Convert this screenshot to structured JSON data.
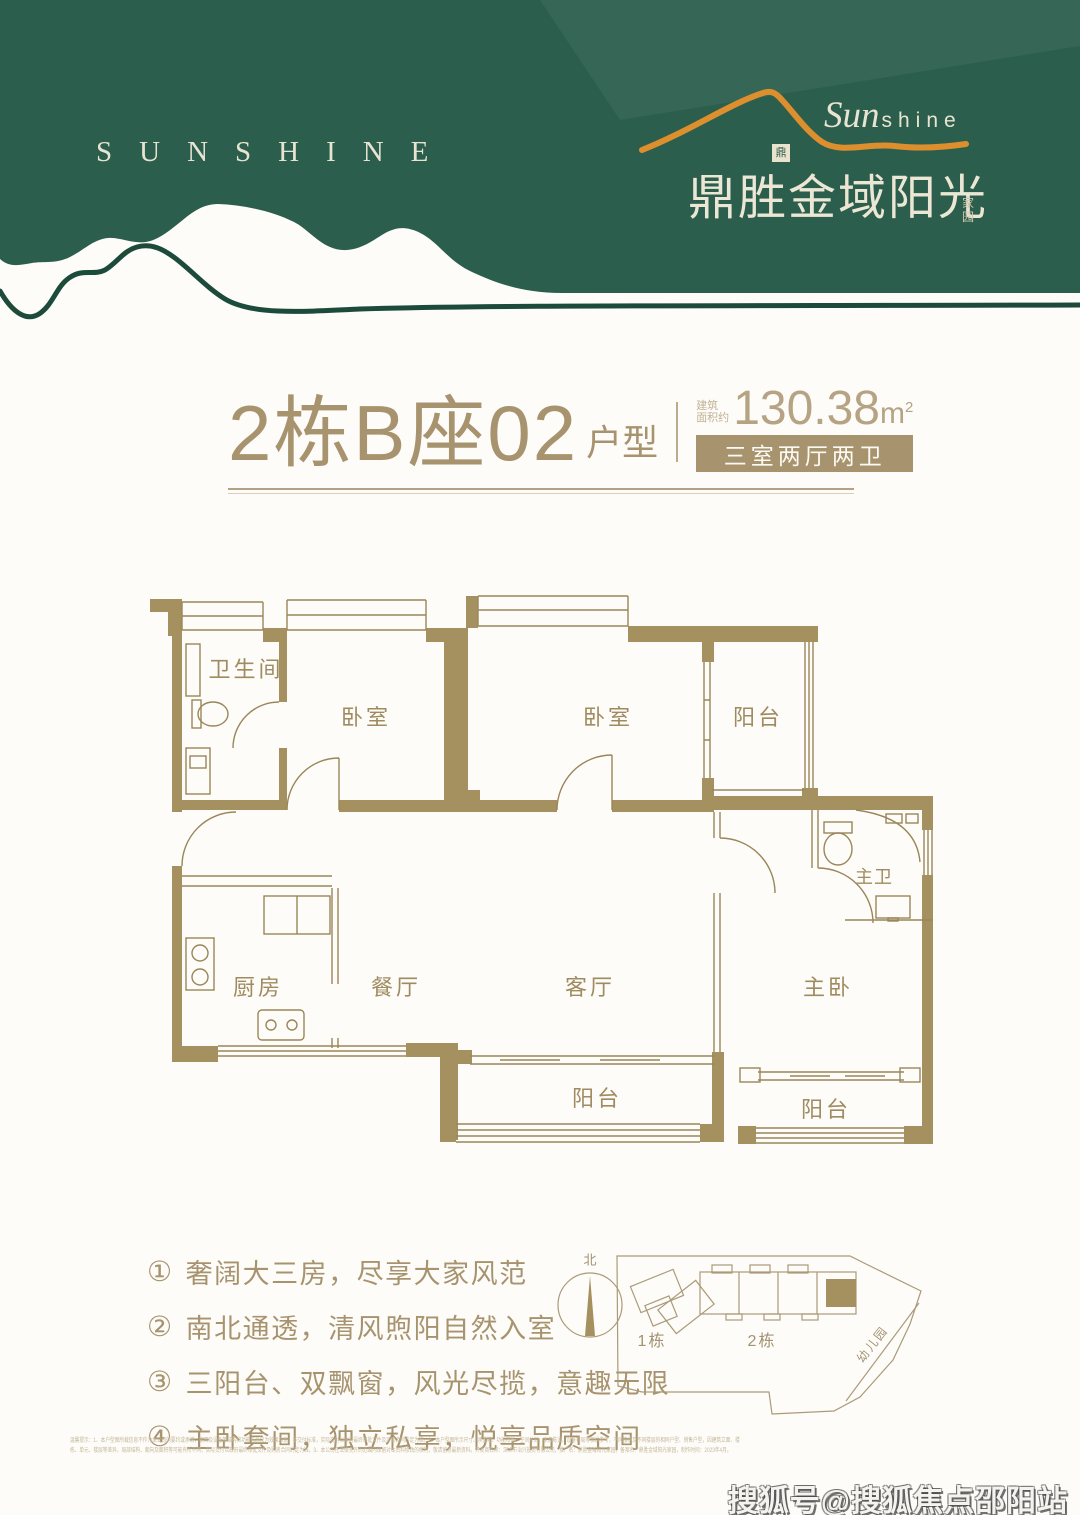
{
  "header": {
    "brand_wordmark": "SUNSHINE",
    "logo_script_primary": "Sun",
    "logo_script_secondary": "shine",
    "logo_cn": "鼎胜金域阳光",
    "logo_cn_suffix": "家园",
    "seal_glyph": "鼎"
  },
  "title": {
    "unit_name": "2栋B座02",
    "unit_suffix": "户型",
    "area_prefix_line1": "建筑",
    "area_prefix_line2": "面积约",
    "area_value": "130.38",
    "area_unit": "m",
    "area_exponent": "2",
    "layout_badge": "三室两厅两卫"
  },
  "floorplan": {
    "rooms": [
      {
        "id": "bathroom",
        "label": "卫生间"
      },
      {
        "id": "bedroom-1",
        "label": "卧室"
      },
      {
        "id": "bedroom-2",
        "label": "卧室"
      },
      {
        "id": "balcony-top",
        "label": "阳台"
      },
      {
        "id": "master-bathroom",
        "label": "主卫"
      },
      {
        "id": "kitchen",
        "label": "厨房"
      },
      {
        "id": "dining-room",
        "label": "餐厅"
      },
      {
        "id": "living-room",
        "label": "客厅"
      },
      {
        "id": "master-bedroom",
        "label": "主卧"
      },
      {
        "id": "balcony-center",
        "label": "阳台"
      },
      {
        "id": "balcony-right",
        "label": "阳台"
      }
    ]
  },
  "features": [
    {
      "num": "①",
      "text": "奢阔大三房，尽享大家风范"
    },
    {
      "num": "②",
      "text": "南北通透，清风煦阳自然入室"
    },
    {
      "num": "③",
      "text": "三阳台、双飘窗，风光尽揽，意趣无限"
    },
    {
      "num": "④",
      "text": "主卧套间，独立私享，悦享品质空间"
    }
  ],
  "sitemap": {
    "north_label": "北",
    "building_1": "1栋",
    "building_2": "2栋",
    "kindergarten": "幼儿园"
  },
  "disclaimer": {
    "line1": "温馨提示：1、本户型图所载信息不作为本公司的要约或承诺，家具及设备等结构和功能布局仅为效果示意，非交付标准，实际交付以政府最终审批文件及买卖合同约定为准。2、本户型图所示尺寸、承重墙、功能布局、空间分割、家具陈设、设备布局等仅供参考，不同楼栋及不同楼层的相同户型、销售户型，因建筑立面、楼",
    "line2": "栋、单元、楼层等差异，局部结构、朝向及面积等可能有所不同，实际交付以政府最终审批文件及购房合同约定为准。3、本公司在法律允许的范围内保留对本资料修改的权利，敬请留意最新资料。开发商名称：深圳市治兴投资有限公司，推广名：鼎胜金域阳光家园，备案名：鼎胜金域阳光家园，制作时间：2023年4月。"
  },
  "watermark": "搜狐号@搜狐焦点邵阳站",
  "colors": {
    "header_green": "#2b5e4d",
    "accent_tan": "#a5905f",
    "mountain_orange": "#dd8f2e",
    "cream": "#e9e4d2"
  }
}
